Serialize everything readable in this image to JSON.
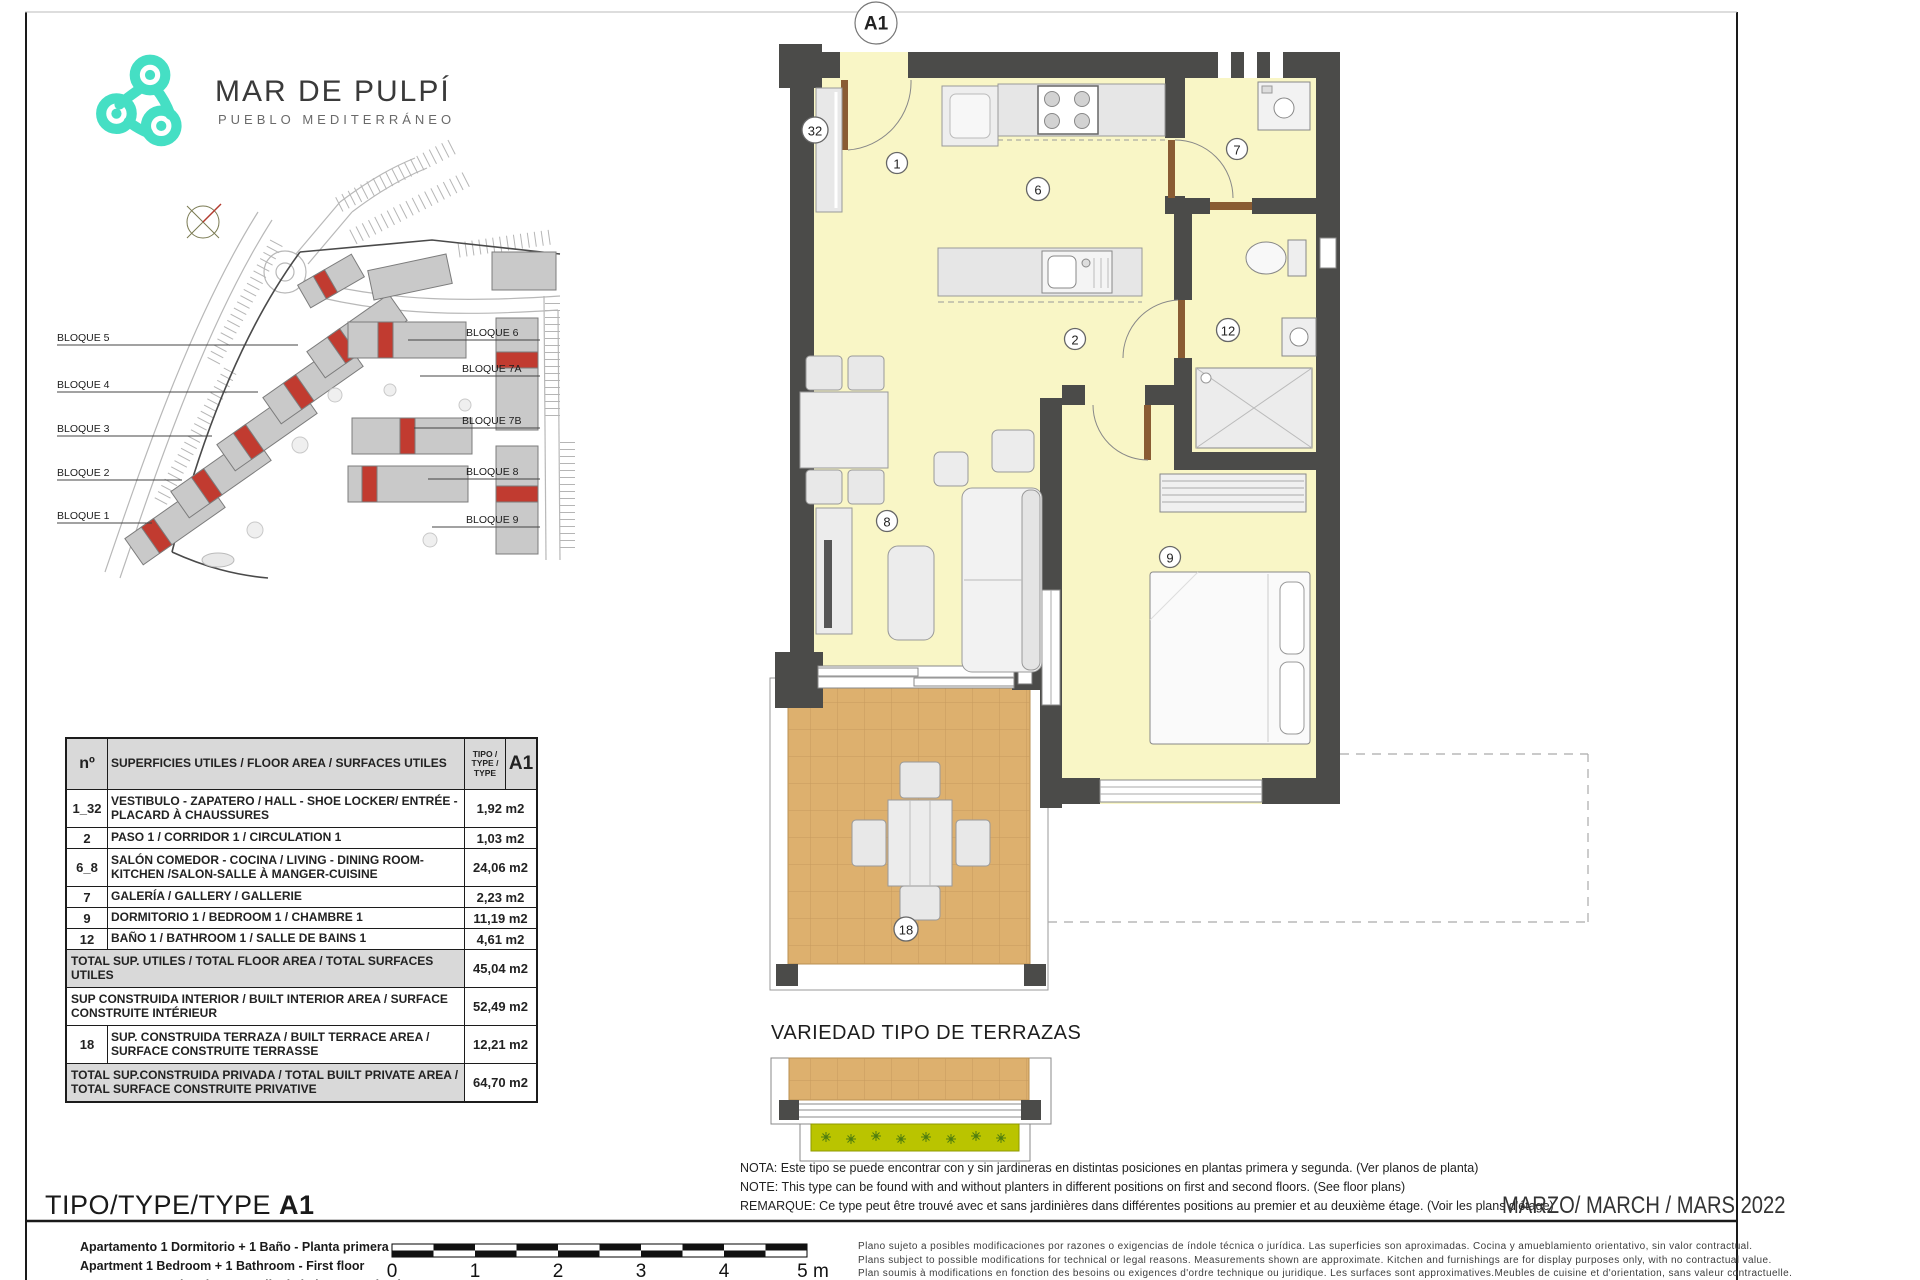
{
  "brand": {
    "name": "MAR DE PULPÍ",
    "tagline": "PUEBLO MEDITERRÁNEO",
    "logo_color": "#45dfc4"
  },
  "plan_code": "A1",
  "site_plan": {
    "blocks_left": [
      "BLOQUE 5",
      "BLOQUE 4",
      "BLOQUE 3",
      "BLOQUE 2",
      "BLOQUE 1"
    ],
    "blocks_right": [
      "BLOQUE 6",
      "BLOQUE 7A",
      "BLOQUE 7B",
      "BLOQUE 8",
      "BLOQUE 9"
    ],
    "highlight_color": "#c13b30"
  },
  "floor_plan": {
    "markers": {
      "m32": "32",
      "m1": "1",
      "m6": "6",
      "m7": "7",
      "m2": "2",
      "m12": "12",
      "m8": "8",
      "m9": "9",
      "m18": "18"
    },
    "colors": {
      "wall": "#4b4b49",
      "floor": "#f9f6c6",
      "terrace": "#ddb06e"
    }
  },
  "area_table": {
    "header": {
      "num": "nº",
      "desc": "SUPERFICIES UTILES / FLOOR AREA / SURFACES UTILES",
      "tipo": "TIPO / TYPE / TYPE",
      "code": "A1"
    },
    "rows": [
      {
        "kind": "normal",
        "tall": true,
        "num": "1_32",
        "desc": "VESTIBULO - ZAPATERO / HALL  - SHOE LOCKER/ ENTRÉE - PLACARD À CHAUSSURES",
        "val": "1,92 m2"
      },
      {
        "kind": "normal",
        "tall": false,
        "num": "2",
        "desc": "PASO 1 / CORRIDOR 1 / CIRCULATION 1",
        "val": "1,03 m2"
      },
      {
        "kind": "normal",
        "tall": true,
        "num": "6_8",
        "desc": "SALÓN COMEDOR - COCINA / LIVING - DINING ROOM- KITCHEN /SALON-SALLE À MANGER-CUISINE",
        "val": "24,06 m2"
      },
      {
        "kind": "normal",
        "tall": false,
        "num": "7",
        "desc": "GALERÍA / GALLERY / GALLERIE",
        "val": "2,23 m2"
      },
      {
        "kind": "normal",
        "tall": false,
        "num": "9",
        "desc": "DORMITORIO 1 / BEDROOM 1 / CHAMBRE 1",
        "val": "11,19 m2"
      },
      {
        "kind": "normal",
        "tall": false,
        "num": "12",
        "desc": "BAÑO 1 / BATHROOM 1 / SALLE DE BAINS 1",
        "val": "4,61 m2"
      },
      {
        "kind": "total",
        "tall": true,
        "desc": "TOTAL SUP. UTILES / TOTAL FLOOR AREA / TOTAL SURFACES UTILES",
        "val": "45,04 m2"
      },
      {
        "kind": "full",
        "tall": true,
        "desc": "SUP CONSTRUIDA INTERIOR / BUILT INTERIOR AREA / SURFACE CONSTRUITE INTÉRIEUR",
        "val": "52,49 m2"
      },
      {
        "kind": "normal",
        "tall": true,
        "num": "18",
        "desc": "SUP. CONSTRUIDA TERRAZA / BUILT TERRACE AREA / SURFACE CONSTRUITE TERRASSE",
        "val": "12,21 m2"
      },
      {
        "kind": "total",
        "tall": true,
        "desc": "TOTAL SUP.CONSTRUIDA PRIVADA / TOTAL  BUILT PRIVATE AREA / TOTAL SURFACE CONSTRUITE PRIVATIVE",
        "val": "64,70 m2"
      }
    ]
  },
  "terrace_variants": {
    "title": "VARIEDAD TIPO DE TERRAZAS"
  },
  "notes": {
    "es": "NOTA: Este tipo se puede encontrar con y sin jardineras en distintas posiciones en plantas primera y segunda. (Ver planos de planta)",
    "en": "NOTE: This type can be found with and without planters in different positions on first and second floors. (See floor plans)",
    "fr": "REMARQUE: Ce type peut être trouvé avec et sans jardinières dans différentes positions au premier et au deuxième étage. (Voir les plans d'étage)"
  },
  "footer": {
    "type_label": "TIPO/TYPE/TYPE ",
    "type_code": "A1",
    "descriptions": [
      "Apartamento 1 Dormitorio + 1 Baño - Planta primera",
      "Apartment 1 Bedroom + 1 Bathroom - First floor",
      "Appartement 1 Chambre + 1 Salle de bains - Premier étage"
    ],
    "date": "MARZO/ MARCH / MARS  2022",
    "scale_ticks": [
      "0",
      "1",
      "2",
      "3",
      "4",
      "5 m"
    ],
    "disclaimer": [
      "Plano sujeto a posibles modificaciones por razones o exigencias de índole técnica o jurídica. Las superficies son aproximadas. Cocina y amueblamiento orientativo, sin valor contractual.",
      "Plans subject to possible modifications for technical or legal reasons. Measurements shown are approximate. Kitchen and furnishings are for display purposes only, with no contractual value.",
      "Plan soumis à modifications en fonction des besoins ou exigences d'ordre technique ou juridique. Les surfaces sont approximatives.Meubles de cuisine et d'orientation, sans valeur contractuelle."
    ]
  }
}
